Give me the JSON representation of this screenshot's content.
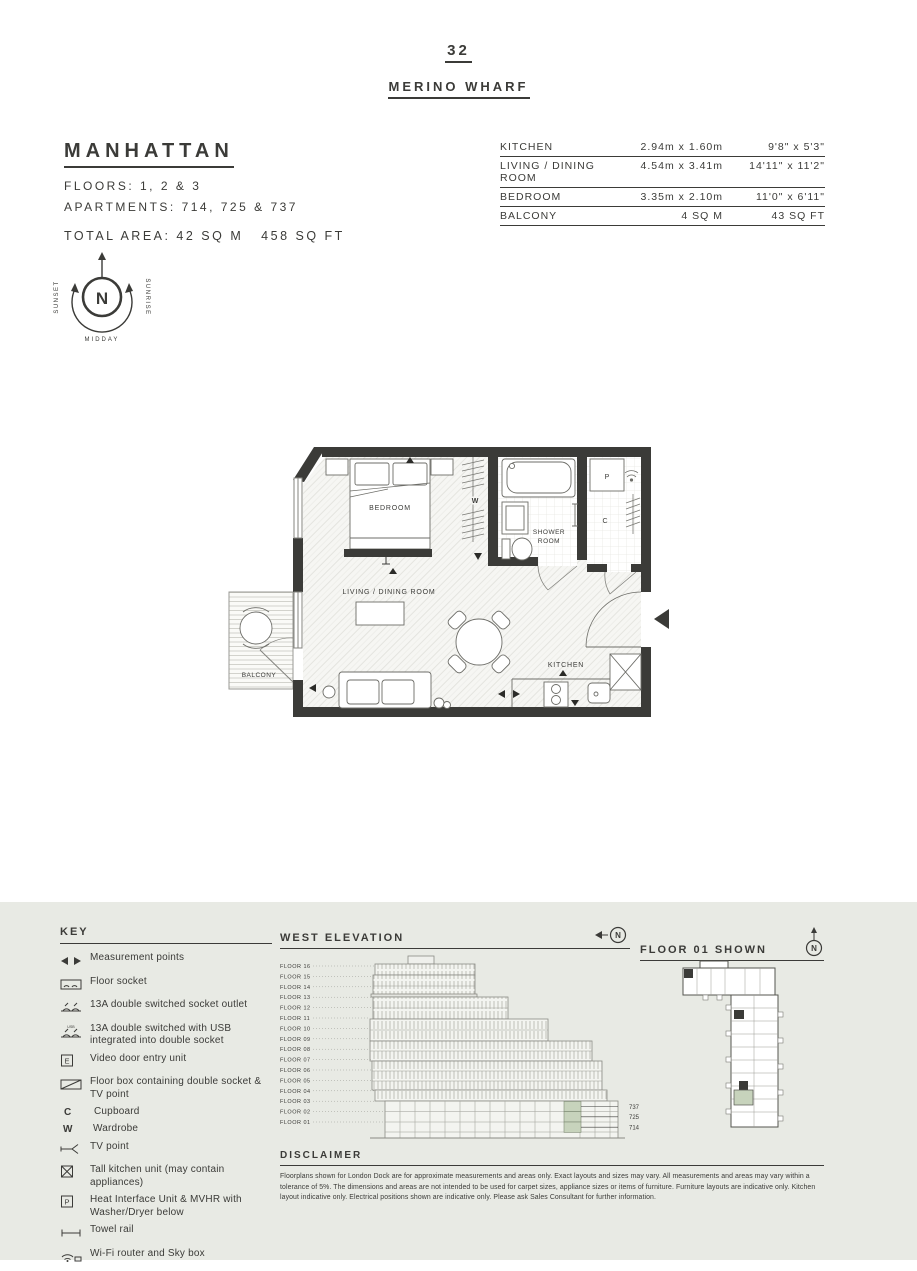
{
  "page": {
    "number": "32",
    "development": "MERINO WHARF"
  },
  "apartment": {
    "name": "MANHATTAN",
    "floors_label": "FLOORS: 1, 2 & 3",
    "apartments_label": "APARTMENTS: 714, 725 & 737",
    "total_area_label": "TOTAL AREA: 42 SQ M   458 SQ FT"
  },
  "dimensions_table": {
    "rows": [
      {
        "room": "KITCHEN",
        "metric": "2.94m x 1.60m",
        "imperial": "9'8\" x 5'3\""
      },
      {
        "room": "LIVING / DINING ROOM",
        "metric": "4.54m x 3.41m",
        "imperial": "14'11\" x 11'2\""
      },
      {
        "room": "BEDROOM",
        "metric": "3.35m x 2.10m",
        "imperial": "11'0\" x 6'11\""
      },
      {
        "room": "BALCONY",
        "metric": "4 SQ M",
        "imperial": "43 SQ FT"
      }
    ]
  },
  "compass": {
    "n": "N",
    "sunset": "SUNSET",
    "sunrise": "SUNRISE",
    "midday": "MIDDAY"
  },
  "floorplan": {
    "rooms": {
      "bedroom": "BEDROOM",
      "living": "LIVING / DINING ROOM",
      "shower_line1": "SHOWER",
      "shower_line2": "ROOM",
      "kitchen": "KITCHEN",
      "balcony": "BALCONY",
      "wardrobe": "W",
      "cupboard": "C",
      "heat_unit": "P"
    }
  },
  "key": {
    "title": "KEY",
    "items": [
      {
        "icon": "measurement-points-icon",
        "label": "Measurement points"
      },
      {
        "icon": "floor-socket-icon",
        "label": "Floor socket"
      },
      {
        "icon": "socket-outlet-icon",
        "label": "13A double switched socket outlet"
      },
      {
        "icon": "socket-usb-icon",
        "icon_text": "USB",
        "label": "13A double switched with USB integrated into double socket"
      },
      {
        "icon": "video-door-entry-icon",
        "glyph": "E",
        "label": "Video door entry unit"
      },
      {
        "icon": "floor-box-icon",
        "label": "Floor box containing double socket & TV point"
      },
      {
        "icon": "cupboard-letter-icon",
        "glyph": "C",
        "label": "Cupboard"
      },
      {
        "icon": "wardrobe-letter-icon",
        "glyph": "W",
        "label": "Wardrobe"
      },
      {
        "icon": "tv-point-icon",
        "label": "TV point"
      },
      {
        "icon": "tall-kitchen-unit-icon",
        "label": "Tall kitchen unit (may contain appliances)"
      },
      {
        "icon": "heat-interface-unit-icon",
        "glyph": "P",
        "label": "Heat Interface Unit & MVHR with Washer/Dryer below"
      },
      {
        "icon": "towel-rail-icon",
        "label": "Towel rail"
      },
      {
        "icon": "wifi-router-icon",
        "label": "Wi-Fi router and Sky box"
      }
    ]
  },
  "west_elevation": {
    "title": "WEST ELEVATION",
    "north": "N",
    "floors": [
      "FLOOR 16",
      "FLOOR 15",
      "FLOOR 14",
      "FLOOR 13",
      "FLOOR 12",
      "FLOOR 11",
      "FLOOR 10",
      "FLOOR 09",
      "FLOOR 08",
      "FLOOR 07",
      "FLOOR 06",
      "FLOOR 05",
      "FLOOR 04",
      "FLOOR 03",
      "FLOOR 02",
      "FLOOR 01"
    ],
    "units": [
      "737",
      "725",
      "714"
    ]
  },
  "floor_shown": {
    "title": "FLOOR 01 SHOWN",
    "north": "N"
  },
  "disclaimer": {
    "title": "DISCLAIMER",
    "text": "Floorplans shown for London Dock are for approximate measurements and areas only. Exact layouts and sizes may vary. All measurements and areas may vary within a tolerance of 5%. The dimensions and areas are not intended to be used for carpet sizes, appliance sizes or items of furniture. Furniture layouts are indicative only. Kitchen layout indicative only. Electrical positions shown are indicative only. Please ask Sales Consultant for further information."
  },
  "colors": {
    "wall": "#3b3b38",
    "band_bg": "#e8eae4",
    "highlight": "#c7d3bc"
  }
}
